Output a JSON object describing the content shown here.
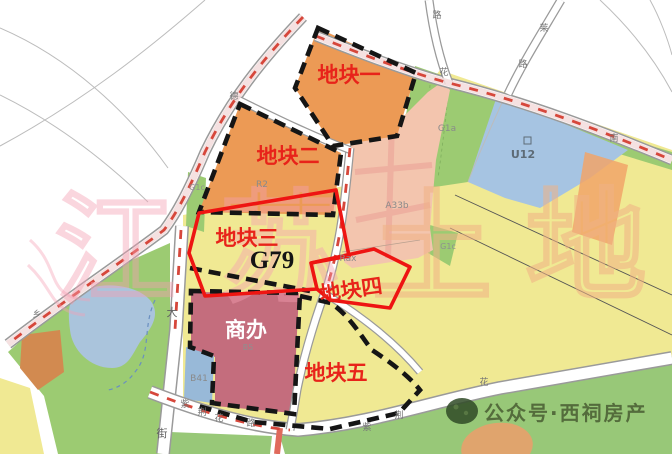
{
  "map": {
    "plots": [
      {
        "label": "地块一"
      },
      {
        "label": "地块二",
        "zone": "R2"
      },
      {
        "label": "地块三",
        "code": "G79"
      },
      {
        "label": "地块四"
      },
      {
        "label": "地块五"
      },
      {
        "label": "商办",
        "zone": "B5"
      }
    ],
    "zones": {
      "g1a": "G1a",
      "g1c_west": "G1c",
      "g1c_east": "G1c",
      "u12": "U12",
      "a33b": "A33b",
      "rax": "Rax",
      "b41": "B41"
    },
    "roads": {
      "lu_top": "路",
      "lai": "莱",
      "lai_lu": "路",
      "hua_mid": "花",
      "nan": "南",
      "de": "德",
      "xiang": "乡",
      "da": "大",
      "jie": "街",
      "zi": "紫",
      "jing": "荆",
      "hua": "花",
      "lu": "路",
      "zi2": "紫",
      "jing2": "荆",
      "hua2": "花"
    },
    "colors": {
      "plot_orange": "#EC9A55",
      "yellow": "#F0E993",
      "rose": "#C46D7D",
      "green": "#9CCB72",
      "green_south": "#98C878",
      "blue_u12": "#A6C4E2",
      "blue_b41": "#98B9D8",
      "salmon": "#F3C5AE",
      "orange_patch": "#D28A50",
      "lake_blue": "#AAC4DC",
      "red_boundary": "#EE1512",
      "red_label": "#E8231A",
      "black_boundary": "#151515"
    }
  },
  "watermarks": {
    "brand_chars": [
      "江",
      "苏",
      "土",
      "地"
    ],
    "footer_text": "公众号·西祠房产"
  }
}
